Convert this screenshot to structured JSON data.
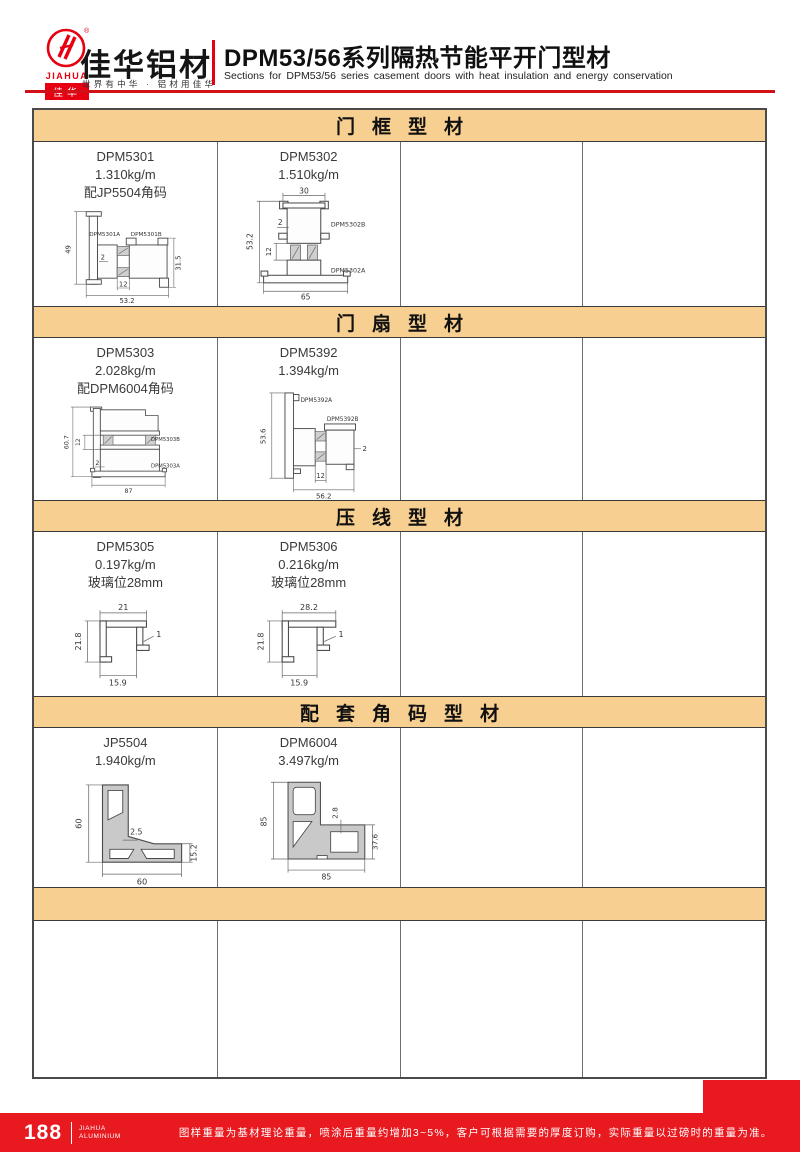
{
  "header": {
    "logo": {
      "en": "JIAHUA",
      "cn": "佳华",
      "reg": "®"
    },
    "brand": "佳华铝材",
    "tagline": "世界有中华 · 铝材用佳华",
    "title": "DPM53/56系列隔热节能平开门型材",
    "subtitle": "Sections for DPM53/56 series casement doors with heat insulation and energy conservation"
  },
  "colors": {
    "brand_red": "#e60012",
    "footer_red": "#e8191f",
    "band_tan": "#f7cf90"
  },
  "sections": [
    {
      "title": "门框型材",
      "profiles": [
        {
          "code": "DPM5301",
          "weight": "1.310kg/m",
          "note": "配JP5504角码",
          "parts": {
            "a": "DPM5301A",
            "b": "DPM5301B"
          },
          "dims": {
            "h": "49",
            "wall": "2",
            "mid": "12",
            "w": "53.2",
            "h2": "31.5"
          }
        },
        {
          "code": "DPM5302",
          "weight": "1.510kg/m",
          "note": "",
          "parts": {
            "a": "DPM5302A",
            "b": "DPM5302B"
          },
          "dims": {
            "top": "30",
            "wall": "2",
            "h": "53.2",
            "mid": "12",
            "w": "65"
          }
        }
      ]
    },
    {
      "title": "门扇型材",
      "profiles": [
        {
          "code": "DPM5303",
          "weight": "2.028kg/m",
          "note": "配DPM6004角码",
          "parts": {
            "a": "DPM5303A",
            "b": "DPM5303B"
          },
          "dims": {
            "h": "60.7",
            "mid": "12",
            "wall": "2",
            "w": "87"
          }
        },
        {
          "code": "DPM5392",
          "weight": "1.394kg/m",
          "note": "",
          "parts": {
            "a": "DPM5392A",
            "b": "DPM5392B"
          },
          "dims": {
            "h": "53.6",
            "mid": "12",
            "wall": "2",
            "w": "56.2"
          }
        }
      ]
    },
    {
      "title": "压线型材",
      "profiles": [
        {
          "code": "DPM5305",
          "weight": "0.197kg/m",
          "note": "玻璃位28mm",
          "dims": {
            "top": "21",
            "h": "21.8",
            "t": "1",
            "w": "15.9"
          }
        },
        {
          "code": "DPM5306",
          "weight": "0.216kg/m",
          "note": "玻璃位28mm",
          "dims": {
            "top": "28.2",
            "h": "21.8",
            "t": "1",
            "w": "15.9"
          }
        }
      ]
    },
    {
      "title": "配套角码型材",
      "profiles": [
        {
          "code": "JP5504",
          "weight": "1.940kg/m",
          "note": "",
          "dims": {
            "h": "60",
            "t": "2.5",
            "r": "15.2",
            "w": "60"
          }
        },
        {
          "code": "DPM6004",
          "weight": "3.497kg/m",
          "note": "",
          "dims": {
            "h": "85",
            "t": "2.8",
            "r": "37.6",
            "w": "85"
          }
        }
      ]
    },
    {
      "title": "",
      "profiles": []
    }
  ],
  "footer": {
    "page": "188",
    "brand_en_1": "JIAHUA",
    "brand_en_2": "ALUMINIUM",
    "disclaimer": "图样重量为基材理论重量，喷涂后重量约增加3~5%，客户可根据需要的厚度订购，实际重量以过磅时的重量为准。"
  }
}
